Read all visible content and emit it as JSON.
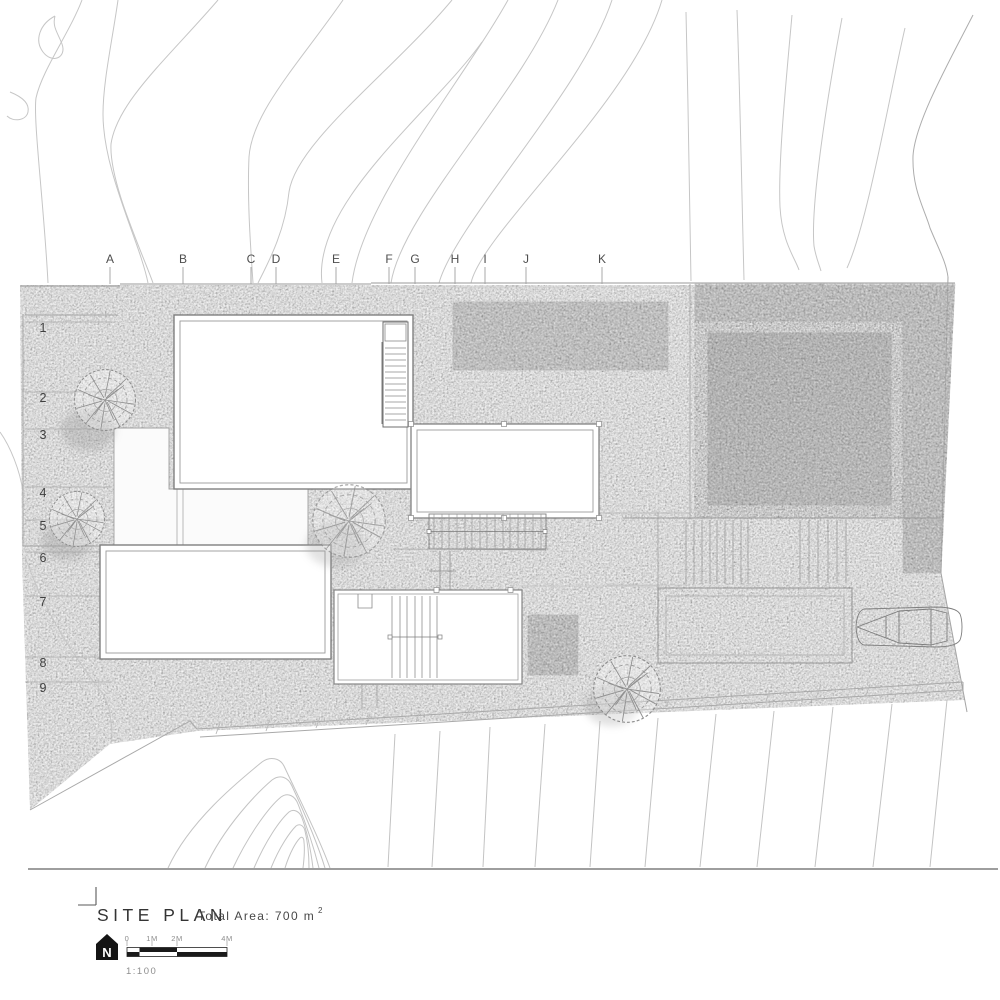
{
  "drawing": {
    "title": "SITE PLAN",
    "total_area_label": "Total Area: 700 m",
    "total_area_sup": "2",
    "scale_label": "1:100",
    "north_label": "N",
    "scale_bar_labels": [
      "0",
      "1M",
      "2M",
      "4M"
    ],
    "grid_columns": [
      "A",
      "B",
      "C",
      "D",
      "E",
      "F",
      "G",
      "H",
      "I",
      "J",
      "K"
    ],
    "grid_rows": [
      "1",
      "2",
      "3",
      "4",
      "5",
      "6",
      "7",
      "8",
      "9"
    ]
  },
  "colors": {
    "ink": "#343434",
    "line": "#9a9a9a",
    "contour": "#c6c6c6",
    "terrain": "#efefef",
    "terrace_gray": "#b7b7b7",
    "pool_dark": "#9b9b9b",
    "pool_light": "#c6c6c6",
    "north_arrow": "#141414"
  }
}
